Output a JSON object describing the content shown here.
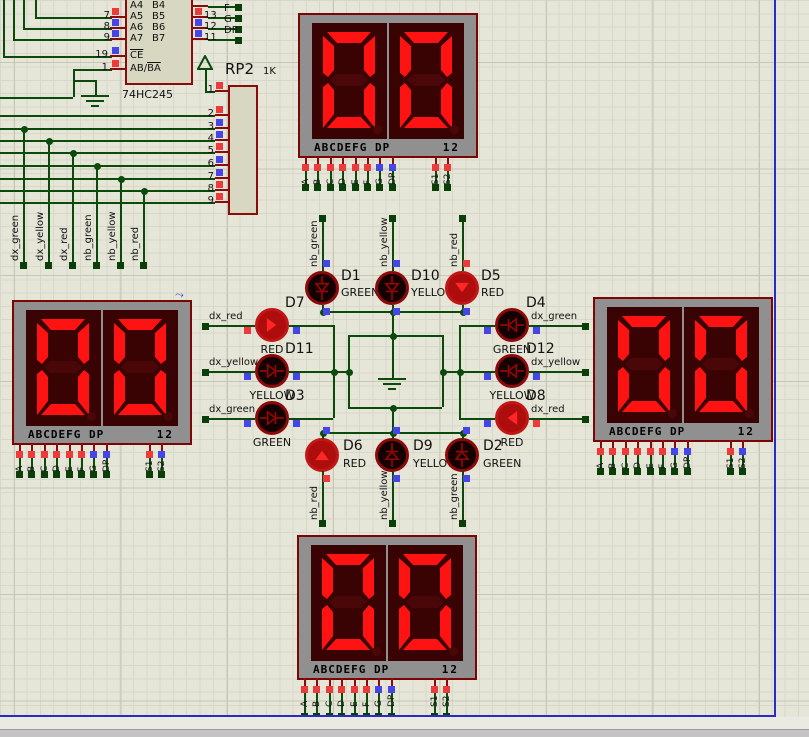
{
  "ic": {
    "name": "74HC245",
    "left_labels": [
      "A4",
      "A5",
      "A6",
      "A7"
    ],
    "right_labels": [
      "B4",
      "B5",
      "B6",
      "B7"
    ],
    "ctrl_label_1": "CE",
    "ctrl_label_2a": "AB/",
    "ctrl_label_2b": "BA",
    "left_pin_numbers": [
      "7",
      "8",
      "9"
    ],
    "left_pin_states": [
      "red",
      "blue",
      "blue"
    ],
    "ctrl_pin_numbers": [
      "19",
      "1"
    ],
    "ctrl_pin_states": [
      "blue",
      "red"
    ],
    "right_pin_numbers": [
      "13",
      "12",
      "11"
    ],
    "right_pin_states": [
      "red",
      "blue",
      "blue"
    ],
    "right_net_labels": [
      "F",
      "G",
      "DP"
    ]
  },
  "rp2": {
    "name": "RP2",
    "value": "1K",
    "pin_numbers": [
      "1",
      "2",
      "3",
      "4",
      "5",
      "6",
      "7",
      "8",
      "9"
    ],
    "pin_states": [
      "red",
      "red",
      "blue",
      "blue",
      "red",
      "blue",
      "blue",
      "red",
      "red"
    ]
  },
  "net_labels": {
    "bus": [
      "dx_green",
      "dx_yellow",
      "dx_red",
      "nb_green",
      "nb_yellow",
      "nb_red"
    ],
    "left": [
      "dx_red",
      "dx_yellow",
      "dx_green"
    ],
    "right": [
      "dx_green",
      "dx_yellow",
      "dx_red"
    ],
    "top": [
      "nb_green",
      "nb_yellow",
      "nb_red"
    ],
    "bottom": [
      "nb_red",
      "nb_yellow",
      "nb_green"
    ]
  },
  "displays": {
    "value": "00",
    "segment_label": "ABCDEFG DP",
    "index_label": "12",
    "pin_labels": [
      "A",
      "B",
      "C",
      "D",
      "E",
      "F",
      "G",
      "DP"
    ],
    "pin_states": [
      "red",
      "red",
      "red",
      "red",
      "red",
      "red",
      "blue",
      "blue"
    ],
    "sel_labels": [
      "S1",
      "S2"
    ],
    "units": [
      {
        "position": "top",
        "sel_states": [
          "red",
          "red"
        ]
      },
      {
        "position": "left",
        "sel_states": [
          "red",
          "blue"
        ]
      },
      {
        "position": "right",
        "sel_states": [
          "red",
          "blue"
        ]
      },
      {
        "position": "bottom",
        "sel_states": [
          "red",
          "red"
        ]
      }
    ]
  },
  "leds": [
    {
      "name": "D1",
      "color": "GREEN",
      "net": "nb_green",
      "state": "unlit",
      "sq": [
        "blue",
        "blue"
      ]
    },
    {
      "name": "D10",
      "color": "YELLOW",
      "net": "nb_yellow",
      "state": "unlit",
      "sq": [
        "blue",
        "blue"
      ]
    },
    {
      "name": "D5",
      "color": "RED",
      "net": "nb_red",
      "state": "lit",
      "sq": [
        "red",
        "blue"
      ]
    },
    {
      "name": "D7",
      "color": "RED",
      "net": "dx_red",
      "state": "lit",
      "sq": [
        "red",
        "blue"
      ]
    },
    {
      "name": "D11",
      "color": "YELLOW",
      "net": "dx_yellow",
      "state": "unlit",
      "sq": [
        "blue",
        "blue"
      ]
    },
    {
      "name": "D3",
      "color": "GREEN",
      "net": "dx_green",
      "state": "unlit",
      "sq": [
        "blue",
        "blue"
      ]
    },
    {
      "name": "D4",
      "color": "GREEN",
      "net": "dx_green",
      "state": "unlit",
      "sq": [
        "blue",
        "blue"
      ]
    },
    {
      "name": "D12",
      "color": "YELLOW",
      "net": "dx_yellow",
      "state": "unlit",
      "sq": [
        "blue",
        "blue"
      ]
    },
    {
      "name": "D8",
      "color": "RED",
      "net": "dx_red",
      "state": "lit",
      "sq": [
        "blue",
        "red"
      ]
    },
    {
      "name": "D6",
      "color": "RED",
      "net": "nb_red",
      "state": "lit",
      "sq": [
        "blue",
        "red"
      ]
    },
    {
      "name": "D9",
      "color": "YELLOW",
      "net": "nb_yellow",
      "state": "unlit",
      "sq": [
        "blue",
        "blue"
      ]
    },
    {
      "name": "D2",
      "color": "GREEN",
      "net": "nb_green",
      "state": "unlit",
      "sq": [
        "blue",
        "blue"
      ]
    }
  ]
}
